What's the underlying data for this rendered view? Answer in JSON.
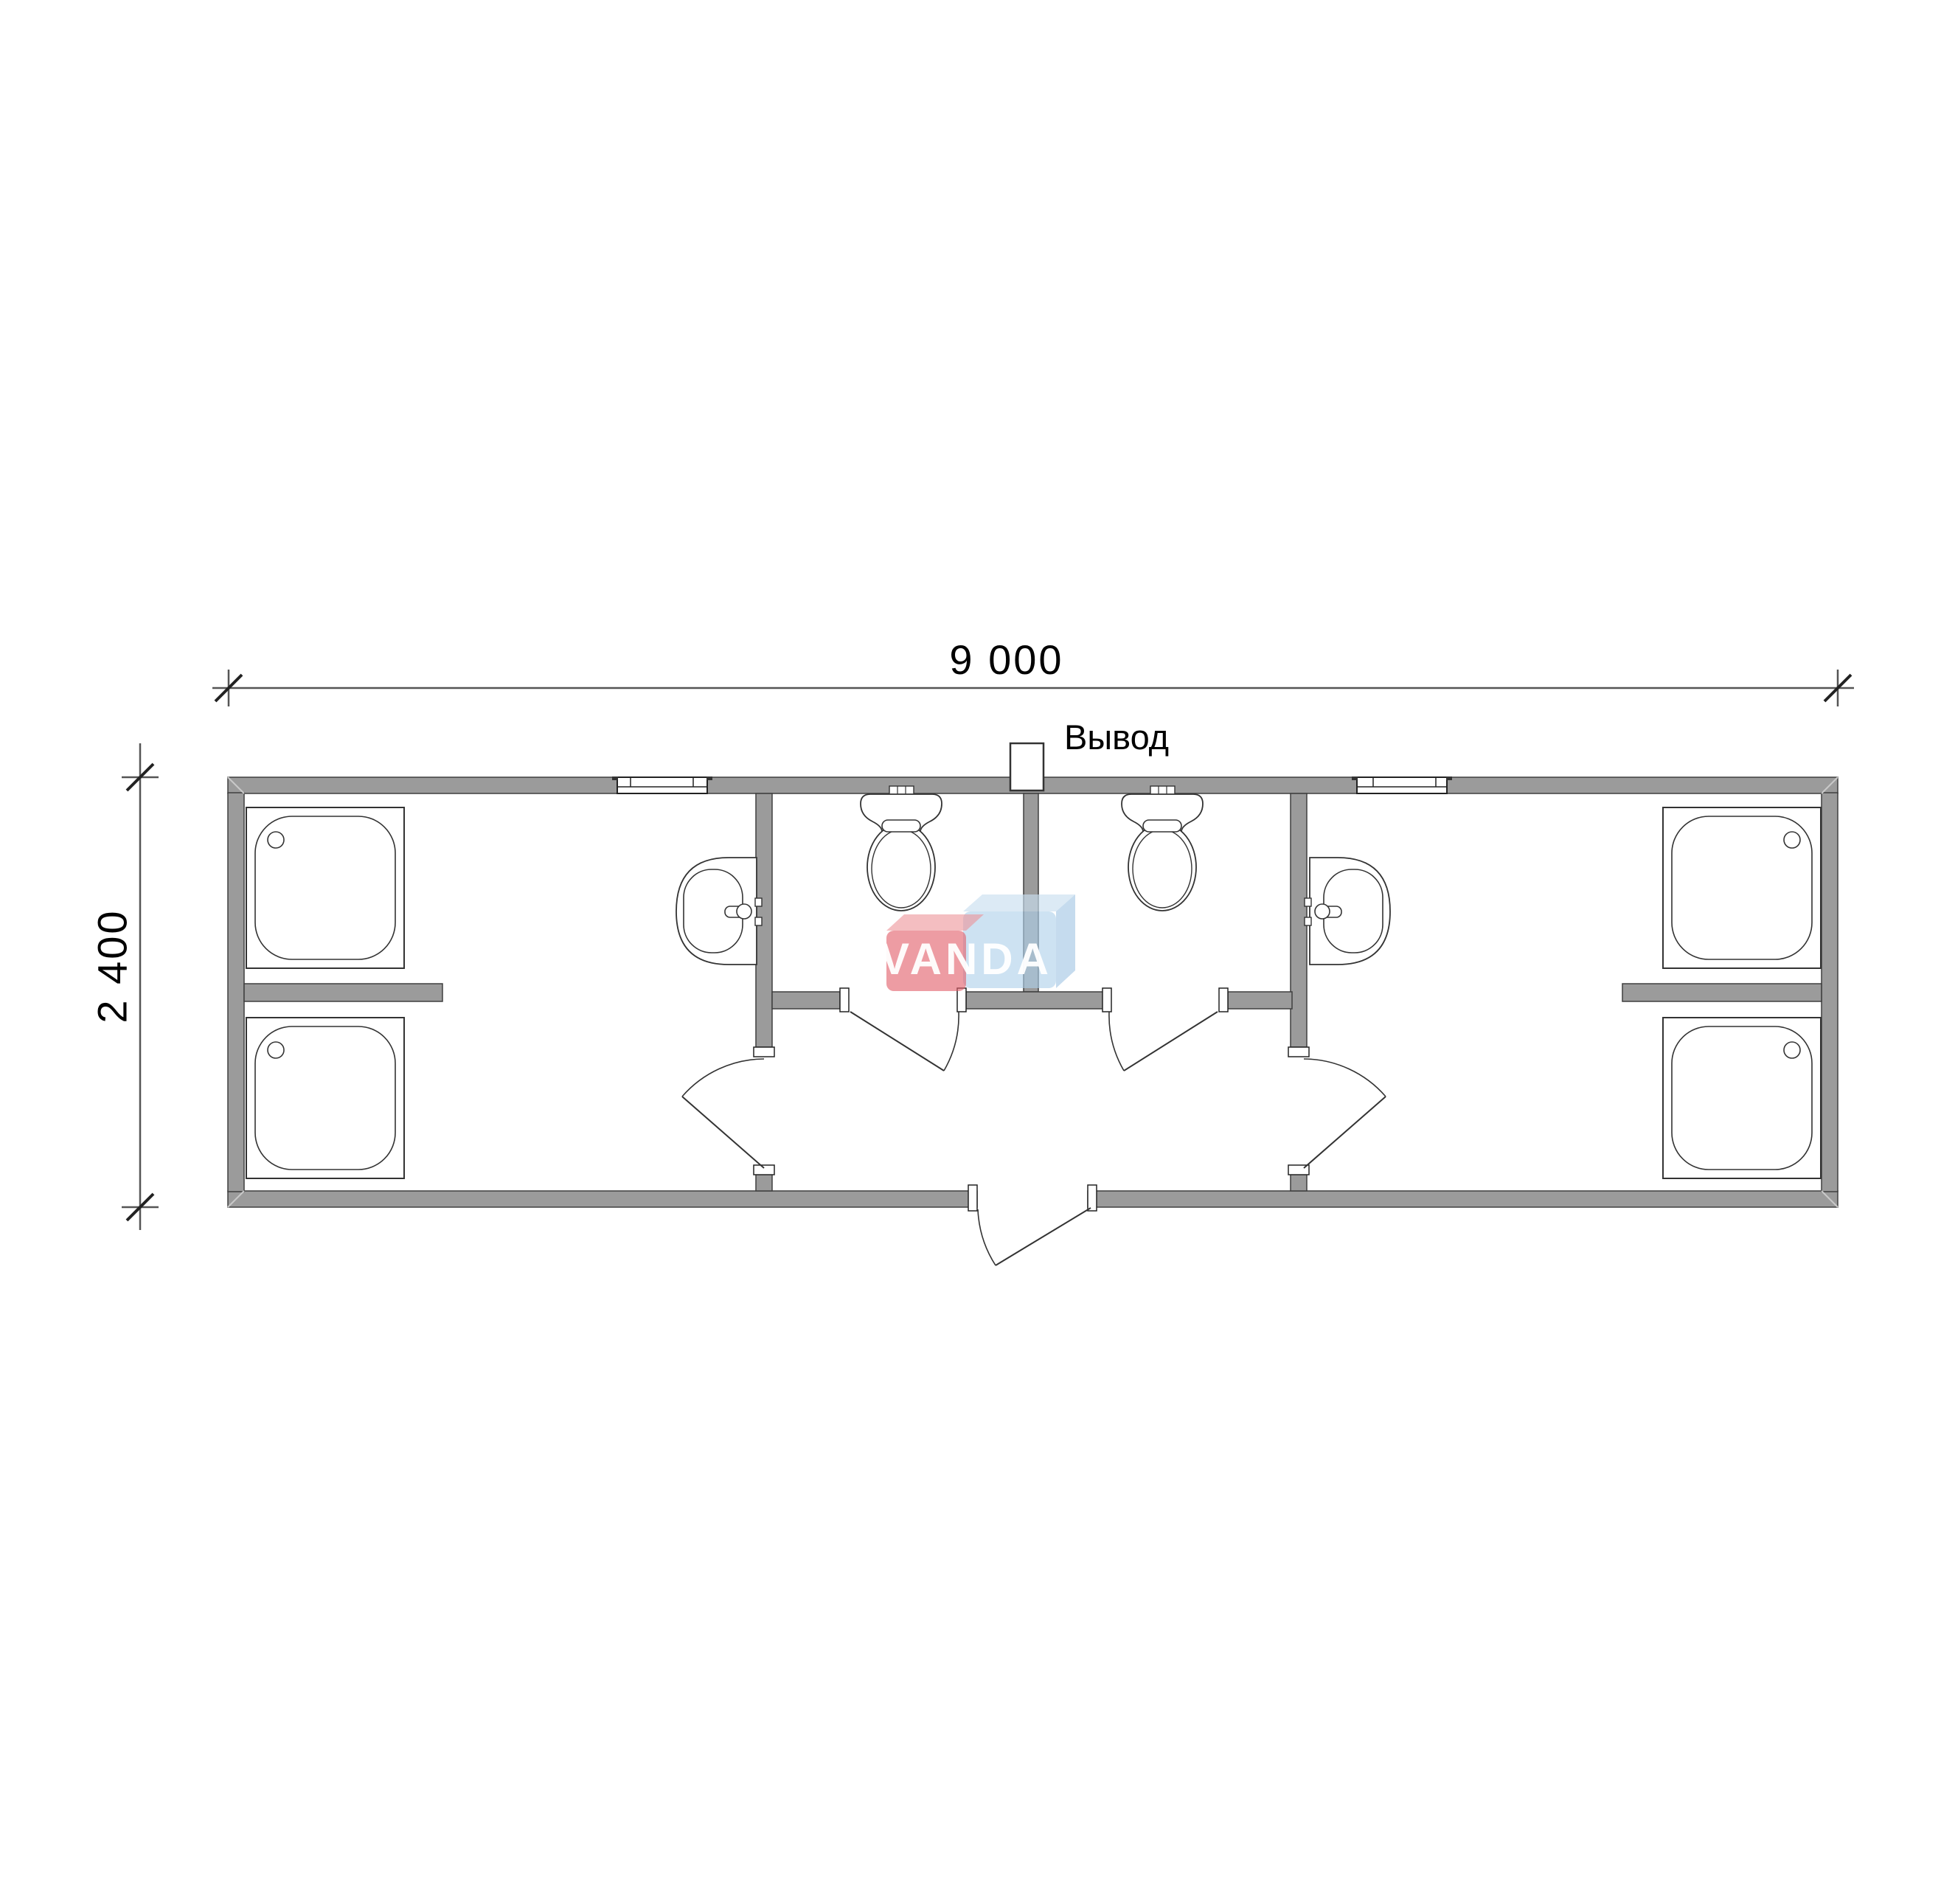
{
  "drawing": {
    "type": "floor-plan",
    "subject": "sanitary container module plan",
    "dimensions": {
      "width_label": "9 000",
      "height_label": "2 400"
    },
    "labels": {
      "outlet": "Вывод"
    },
    "watermark": {
      "text": "VANDA",
      "red_color": "#e2606b",
      "blue_color": "#aed0ea"
    },
    "colors": {
      "background": "#ffffff",
      "wall_fill": "#9b9b9b",
      "line": "#333333",
      "dimension_line": "#555555"
    },
    "fixtures": {
      "shower_trays": 4,
      "toilets": 2,
      "washbasins": 2,
      "windows": 2,
      "interior_doors": 4,
      "exterior_doors": 1,
      "utility_outlets": 1
    }
  }
}
